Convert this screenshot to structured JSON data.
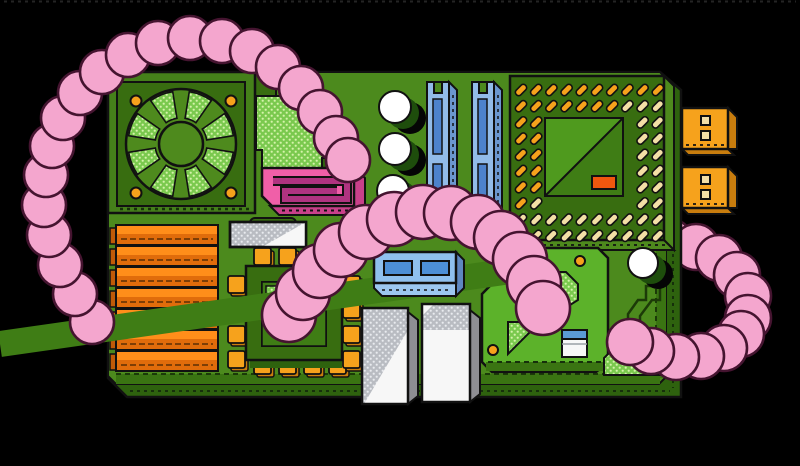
{
  "scene": {
    "width": 800,
    "height": 466,
    "background": "#000000",
    "subject": "motherboard-with-worms-illustration"
  },
  "palette": {
    "bg": "#000000",
    "boardFace": "#4C8A1D",
    "boardBevel": "#3A7412",
    "boardSide": "#2E620E",
    "platform": "#5CB22A",
    "moduleFrame": "#45801A",
    "moduleDark": "#386D10",
    "bladeGreen": "#4E8A1D",
    "innerTL": "#4F9A1E",
    "innerBR": "#3F7D15",
    "dotsBgGreen": "#7AC94E",
    "dotsFgGreen": "#D5F3AA",
    "orange": "#F6A21C",
    "orangeSide": "#C87D0E",
    "heatTop": "#FF8E1A",
    "heatFront": "#E06C0B",
    "heatEnd": "#C05A08",
    "cream": "#F3DFA6",
    "redOrange": "#F0570F",
    "sataPink": "#F05FA8",
    "sataPanel": "#B03380",
    "sataSide": "#C9408A",
    "wormPink": "#F4A6CE",
    "wormLine": "#451430",
    "ramBlue": "#92BBE8",
    "ramSlot": "#4D82CC",
    "ramSide": "#6B97CF",
    "connTop": "#8FC0EE",
    "connFront": "#9CC7F0",
    "connInner": "#4D8FD6",
    "connSide": "#5E87C0",
    "biosBlue": "#5B9BD5",
    "white": "#F7F7F7",
    "grayDotsBg": "#B9BCC2",
    "grayDotsFg": "#E9EBEF",
    "graySide": "#8E8E93",
    "shadowGreen": "#1E4D0C",
    "outline": "#111111",
    "black": "#000000"
  },
  "fan": {
    "cx": 181,
    "cy": 144,
    "disc_r": 55,
    "hub_r": 22,
    "wedge_r1": 26,
    "wedge_r2": 53,
    "half_angle": 13,
    "wedge_angles": [
      22,
      68,
      112,
      158,
      202,
      248,
      292,
      338
    ],
    "screws": [
      [
        136,
        101
      ],
      [
        231,
        101
      ],
      [
        136,
        193
      ],
      [
        231,
        193
      ]
    ],
    "screw_r": 5.5
  },
  "heatsink": {
    "x": 116,
    "width": 102,
    "y0": 225,
    "pitch": 21,
    "bar_h": 20,
    "top_h": 8,
    "count": 7
  },
  "cpu_socket": {
    "origin_x": 521,
    "origin_y": 90,
    "pitch_x": 15.2,
    "pitch_y": 16.2,
    "rows": 10,
    "cols": 10,
    "pin_w": 13,
    "pin_h": 6.5,
    "row_colors": [
      "oooooooooo",
      "oooooooccc",
      "oo......cc",
      "oo......cc",
      "oo......cc",
      "oo......cc",
      "oo......cc",
      "oc......cc",
      "cccccccccc",
      "occccccccc"
    ]
  },
  "chip_pins": {
    "size": 17,
    "top_y": 248,
    "bottom_y": 357,
    "xs": [
      254,
      279,
      304,
      329
    ],
    "left_x": 228,
    "right_x": 343,
    "ys": [
      276,
      301,
      326,
      351
    ]
  },
  "small_capacitors": {
    "r": 16,
    "centers": [
      [
        395,
        107
      ],
      [
        395,
        149
      ],
      [
        393,
        191
      ]
    ]
  },
  "big_capacitor": {
    "r": 15,
    "center": [
      643,
      263
    ]
  },
  "vias": {
    "r": 5,
    "centers": [
      [
        580,
        261
      ],
      [
        493,
        350
      ]
    ]
  },
  "worms": {
    "a": {
      "r": 22,
      "pts": [
        [
          92,
          322
        ],
        [
          75,
          294
        ],
        [
          60,
          265
        ],
        [
          49,
          235
        ],
        [
          44,
          205
        ],
        [
          46,
          175
        ],
        [
          52,
          146
        ],
        [
          63,
          118
        ],
        [
          80,
          93
        ],
        [
          102,
          72
        ],
        [
          128,
          55
        ],
        [
          158,
          43
        ],
        [
          190,
          38
        ],
        [
          222,
          41
        ],
        [
          252,
          51
        ],
        [
          278,
          67
        ],
        [
          301,
          88
        ],
        [
          320,
          112
        ],
        [
          336,
          138
        ],
        [
          348,
          160
        ]
      ]
    },
    "b": {
      "r": 27,
      "pts": [
        [
          289,
          315
        ],
        [
          303,
          293
        ],
        [
          320,
          271
        ],
        [
          341,
          250
        ],
        [
          366,
          232
        ],
        [
          394,
          219
        ],
        [
          423,
          212
        ],
        [
          451,
          213
        ],
        [
          478,
          222
        ],
        [
          501,
          238
        ],
        [
          520,
          259
        ],
        [
          534,
          283
        ],
        [
          543,
          308
        ]
      ]
    },
    "c_tail": {
      "r": 23,
      "pts": [
        [
          644,
          243
        ],
        [
          670,
          242
        ],
        [
          696,
          247
        ],
        [
          719,
          258
        ],
        [
          737,
          275
        ],
        [
          748,
          296
        ],
        [
          748,
          318
        ]
      ]
    },
    "c_head": {
      "r": 23,
      "pts": [
        [
          741,
          334
        ],
        [
          724,
          348
        ],
        [
          701,
          356
        ],
        [
          676,
          357
        ],
        [
          651,
          351
        ],
        [
          630,
          342
        ]
      ]
    }
  }
}
